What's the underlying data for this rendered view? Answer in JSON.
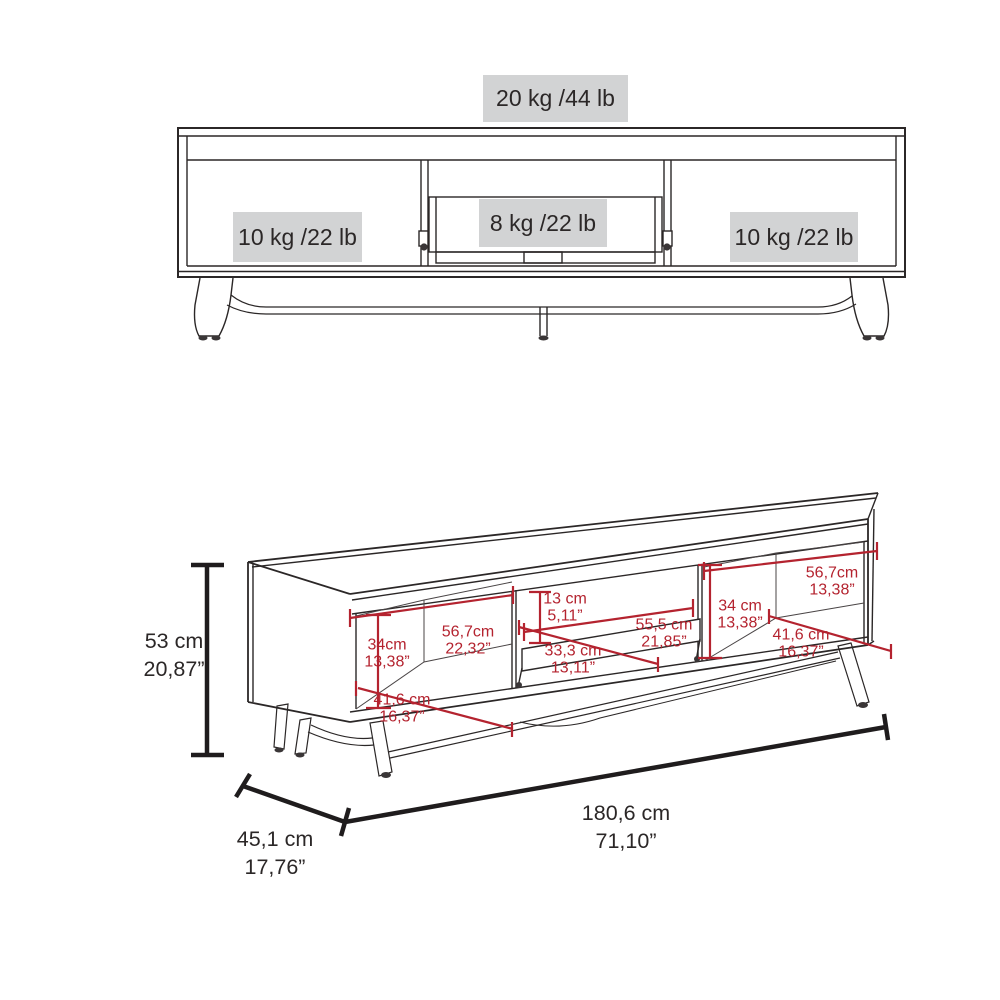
{
  "figure": {
    "type": "furniture-dimension-diagram",
    "views": [
      "front-elevation-weight-capacity",
      "perspective-dimensions"
    ]
  },
  "front_view": {
    "weight_labels": {
      "top_surface": "20 kg /44 lb",
      "left_compartment": "10 kg /22 lb",
      "center_compartment": "8 kg /22 lb",
      "right_compartment": "10 kg /22 lb"
    }
  },
  "dimension_view": {
    "overall": {
      "height": {
        "cm": "53 cm",
        "in": "20,87”"
      },
      "depth": {
        "cm": "45,1 cm",
        "in": "17,76”"
      },
      "width": {
        "cm": "180,6 cm",
        "in": "71,10”"
      }
    },
    "inner": {
      "left_height": {
        "cm": "34cm",
        "in": "13,38”"
      },
      "left_width": {
        "cm": "56,7cm",
        "in": "22,32”"
      },
      "left_depth": {
        "cm": "41,6 cm",
        "in": "16,37”"
      },
      "center_height": {
        "cm": "13 cm",
        "in": "5,11”"
      },
      "center_width": {
        "cm": "55,5 cm",
        "in": "21,85”"
      },
      "center_depth": {
        "cm": "33,3 cm",
        "in": "13,11”"
      },
      "right_height": {
        "cm": "34 cm",
        "in": "13,38”"
      },
      "right_width": {
        "cm": "56,7cm",
        "in": "13,38”"
      },
      "right_depth": {
        "cm": "41,6 cm",
        "in": "16,37”"
      }
    }
  },
  "colors": {
    "line": "#2b2727",
    "dimension_red": "#b4232f",
    "label_bg": "#d2d3d4",
    "background": "#ffffff"
  }
}
